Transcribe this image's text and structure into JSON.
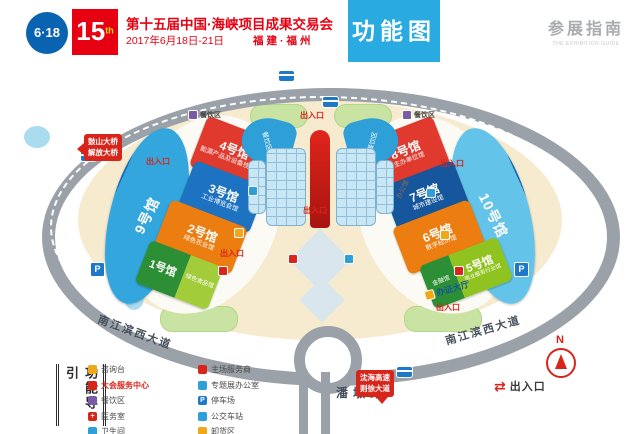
{
  "header": {
    "logo_618": "6·18",
    "logo_15": "15",
    "logo_15_sup": "th",
    "title": "第十五届中国·海峡项目成果交易会",
    "date": "2017年6月18日-21日",
    "place": "福建·福州",
    "map_tag": "功能图",
    "guide_cn": "参展指南",
    "guide_en": "THE EXHIBITION GUIDE"
  },
  "halls": {
    "h1": {
      "label": "1号馆",
      "sub": "绿色食品馆"
    },
    "h2": {
      "label": "2号馆",
      "sub": "绿色农业馆"
    },
    "h3": {
      "label": "3号馆",
      "sub": "工业博览会馆"
    },
    "h4": {
      "label": "4号馆",
      "sub": "能源产品及设备技术馆"
    },
    "h5": {
      "label": "5号馆",
      "sub": "商业服务行业馆",
      "annex": "金融馆"
    },
    "h6": {
      "label": "6号馆",
      "sub": "数字经济馆"
    },
    "h7": {
      "label": "7号馆",
      "sub": "城市建设馆"
    },
    "h8": {
      "label": "8号馆",
      "sub": "主办单位馆"
    },
    "h9": {
      "label": "9号馆"
    },
    "h10": {
      "label": "10号馆"
    }
  },
  "map": {
    "entrance": "出入口",
    "dining": "餐饮区",
    "office": "办公馆",
    "cert_hall": "办证大厅",
    "road_left": "南江滨西大道",
    "road_right": "南江滨西大道",
    "road_bottom": "潘墩路",
    "bridge_sign_line1": "鼓山大桥",
    "bridge_sign_line2": "解放大桥",
    "highway_sign_line1": "沈海高速",
    "highway_sign_line2": "则徐大道",
    "north": "N",
    "parking": "P"
  },
  "legend": {
    "title": "功能导引",
    "col1": [
      {
        "label": "咨询台",
        "color": "#f0a818"
      },
      {
        "label": "大会服务中心",
        "color": "#d8251b"
      },
      {
        "label": "餐饮区",
        "color": "#7a5ba8"
      },
      {
        "label": "医务室",
        "color": "#d8251b"
      },
      {
        "label": "卫生间",
        "color": "#2f9fd8"
      }
    ],
    "col2": [
      {
        "label": "主场服务商",
        "color": "#d8251b"
      },
      {
        "label": "专题展办公室",
        "color": "#2f9fd8"
      },
      {
        "label": "停车场",
        "color": "#1e78c8"
      },
      {
        "label": "公交车站",
        "color": "#1e78c8"
      },
      {
        "label": "卸货区",
        "color": "#f0a818"
      }
    ],
    "exit_label": "出入口"
  },
  "colors": {
    "accent_blue": "#29abe2",
    "brand_red": "#e60012",
    "hall_red": "#e03a2e",
    "hall_orange": "#ec7d10",
    "hall_blue": "#1d72c2",
    "hall_green": "#2c8f35",
    "campus": "#f6ebcf",
    "road": "#9aa1a8"
  }
}
